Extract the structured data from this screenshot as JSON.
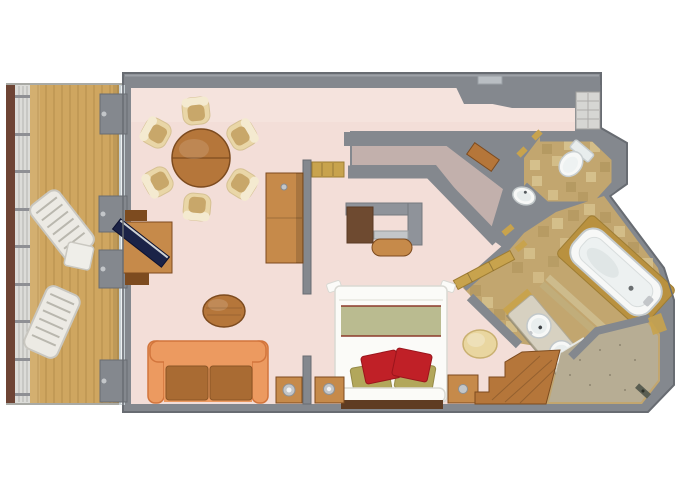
{
  "meta": {
    "title": "Suite floor plan",
    "description": "3D top-down floor plan of a ship suite with private veranda, living and dining room, bedroom, walk-in closet corridor, entry hall, separate toilet room and bathroom",
    "canvas": {
      "width": 680,
      "height": 486
    }
  },
  "rooms": [
    {
      "id": "veranda",
      "label": "Private veranda with teak deck"
    },
    {
      "id": "living-dining",
      "label": "Living and dining room"
    },
    {
      "id": "bedroom",
      "label": "Bedroom"
    },
    {
      "id": "closet-corridor",
      "label": "Walk-in closet corridor"
    },
    {
      "id": "entry-hall",
      "label": "Entry hall"
    },
    {
      "id": "toilet-room",
      "label": "Separate toilet room"
    },
    {
      "id": "bathroom",
      "label": "Bathroom with tub, double vanity and shower"
    }
  ],
  "furniture": {
    "veranda": [
      "railing",
      "teak deck",
      "lounge chair",
      "lounge chair",
      "side table"
    ],
    "living_dining": [
      "round dining table",
      "six cream tub chairs",
      "orange sofa with brown cushions",
      "oval coffee table",
      "media desk with flat TV",
      "tall bar cabinet",
      "corner lamp table"
    ],
    "bedroom": [
      "double bed with olive runner and red pillows",
      "nightstand with lamp",
      "wooden dresser",
      "vanity desk with stool",
      "round ottoman",
      "luggage bench",
      "wood step to bathroom"
    ],
    "closet_corridor": [
      "carpeted wardrobe corridor",
      "wooden console"
    ],
    "toilet_room": [
      "toilet",
      "washbasin"
    ],
    "bathroom": [
      "bathtub on wood deck",
      "double-sink marble vanity",
      "shower",
      "tiled floor"
    ]
  },
  "palette": {
    "wall": "#84888e",
    "wallDark": "#686c72",
    "wallLight": "#a4a8ae",
    "carpet": "#f3ded8",
    "carpetLight": "#f8e9e4",
    "corridorCarpet": "#c2b0ac",
    "deckWood": "#cfa660",
    "deckPlank": "#a98344",
    "railWood": "#6e4434",
    "railMesh": "#dcdcd8",
    "glass": "#c6cfd3",
    "wood": "#b5763a",
    "woodDark": "#7d4b1f",
    "woodLight": "#c68a4a",
    "chairCream": "#e9d6a7",
    "chairInner": "#c8a76a",
    "chairRim": "#f4ead0",
    "sofa": "#ec9a60",
    "sofaEdge": "#d2753c",
    "cushion": "#a96b33",
    "tvNavy": "#1b2347",
    "bedWhite": "#fbfbf8",
    "bedOlive": "#babb90",
    "pillowRed": "#c02027",
    "pillowOlive": "#b2a75b",
    "bedTrim": "#8c3a2a",
    "bench": "#5f3c22",
    "silver": "#c3c6c9",
    "ottoman": "#e9d6a0",
    "tile": "#c2a66f",
    "tileLight": "#dac793",
    "tileDark": "#a78b53",
    "marble": "#d7d1c1",
    "porcelain": "#f7f8f7",
    "porcelainDim": "#e8eded",
    "fixtureShadow": "#c7cdcf",
    "showerTile": "#b7ad94",
    "gold": "#c8a34d",
    "goldDark": "#9e7d33",
    "shelf": "#d6d6d3",
    "doorSlab": "#b9bec3",
    "deskGray": "#8f939a",
    "deskCab": "#6e4a30",
    "tubDeck": "#b9913f",
    "stepLight": "#cdbb8c",
    "stepDark": "#c1ad7a",
    "loungerWhite": "#eceae4",
    "loungerEdge": "#c9c7c0"
  }
}
